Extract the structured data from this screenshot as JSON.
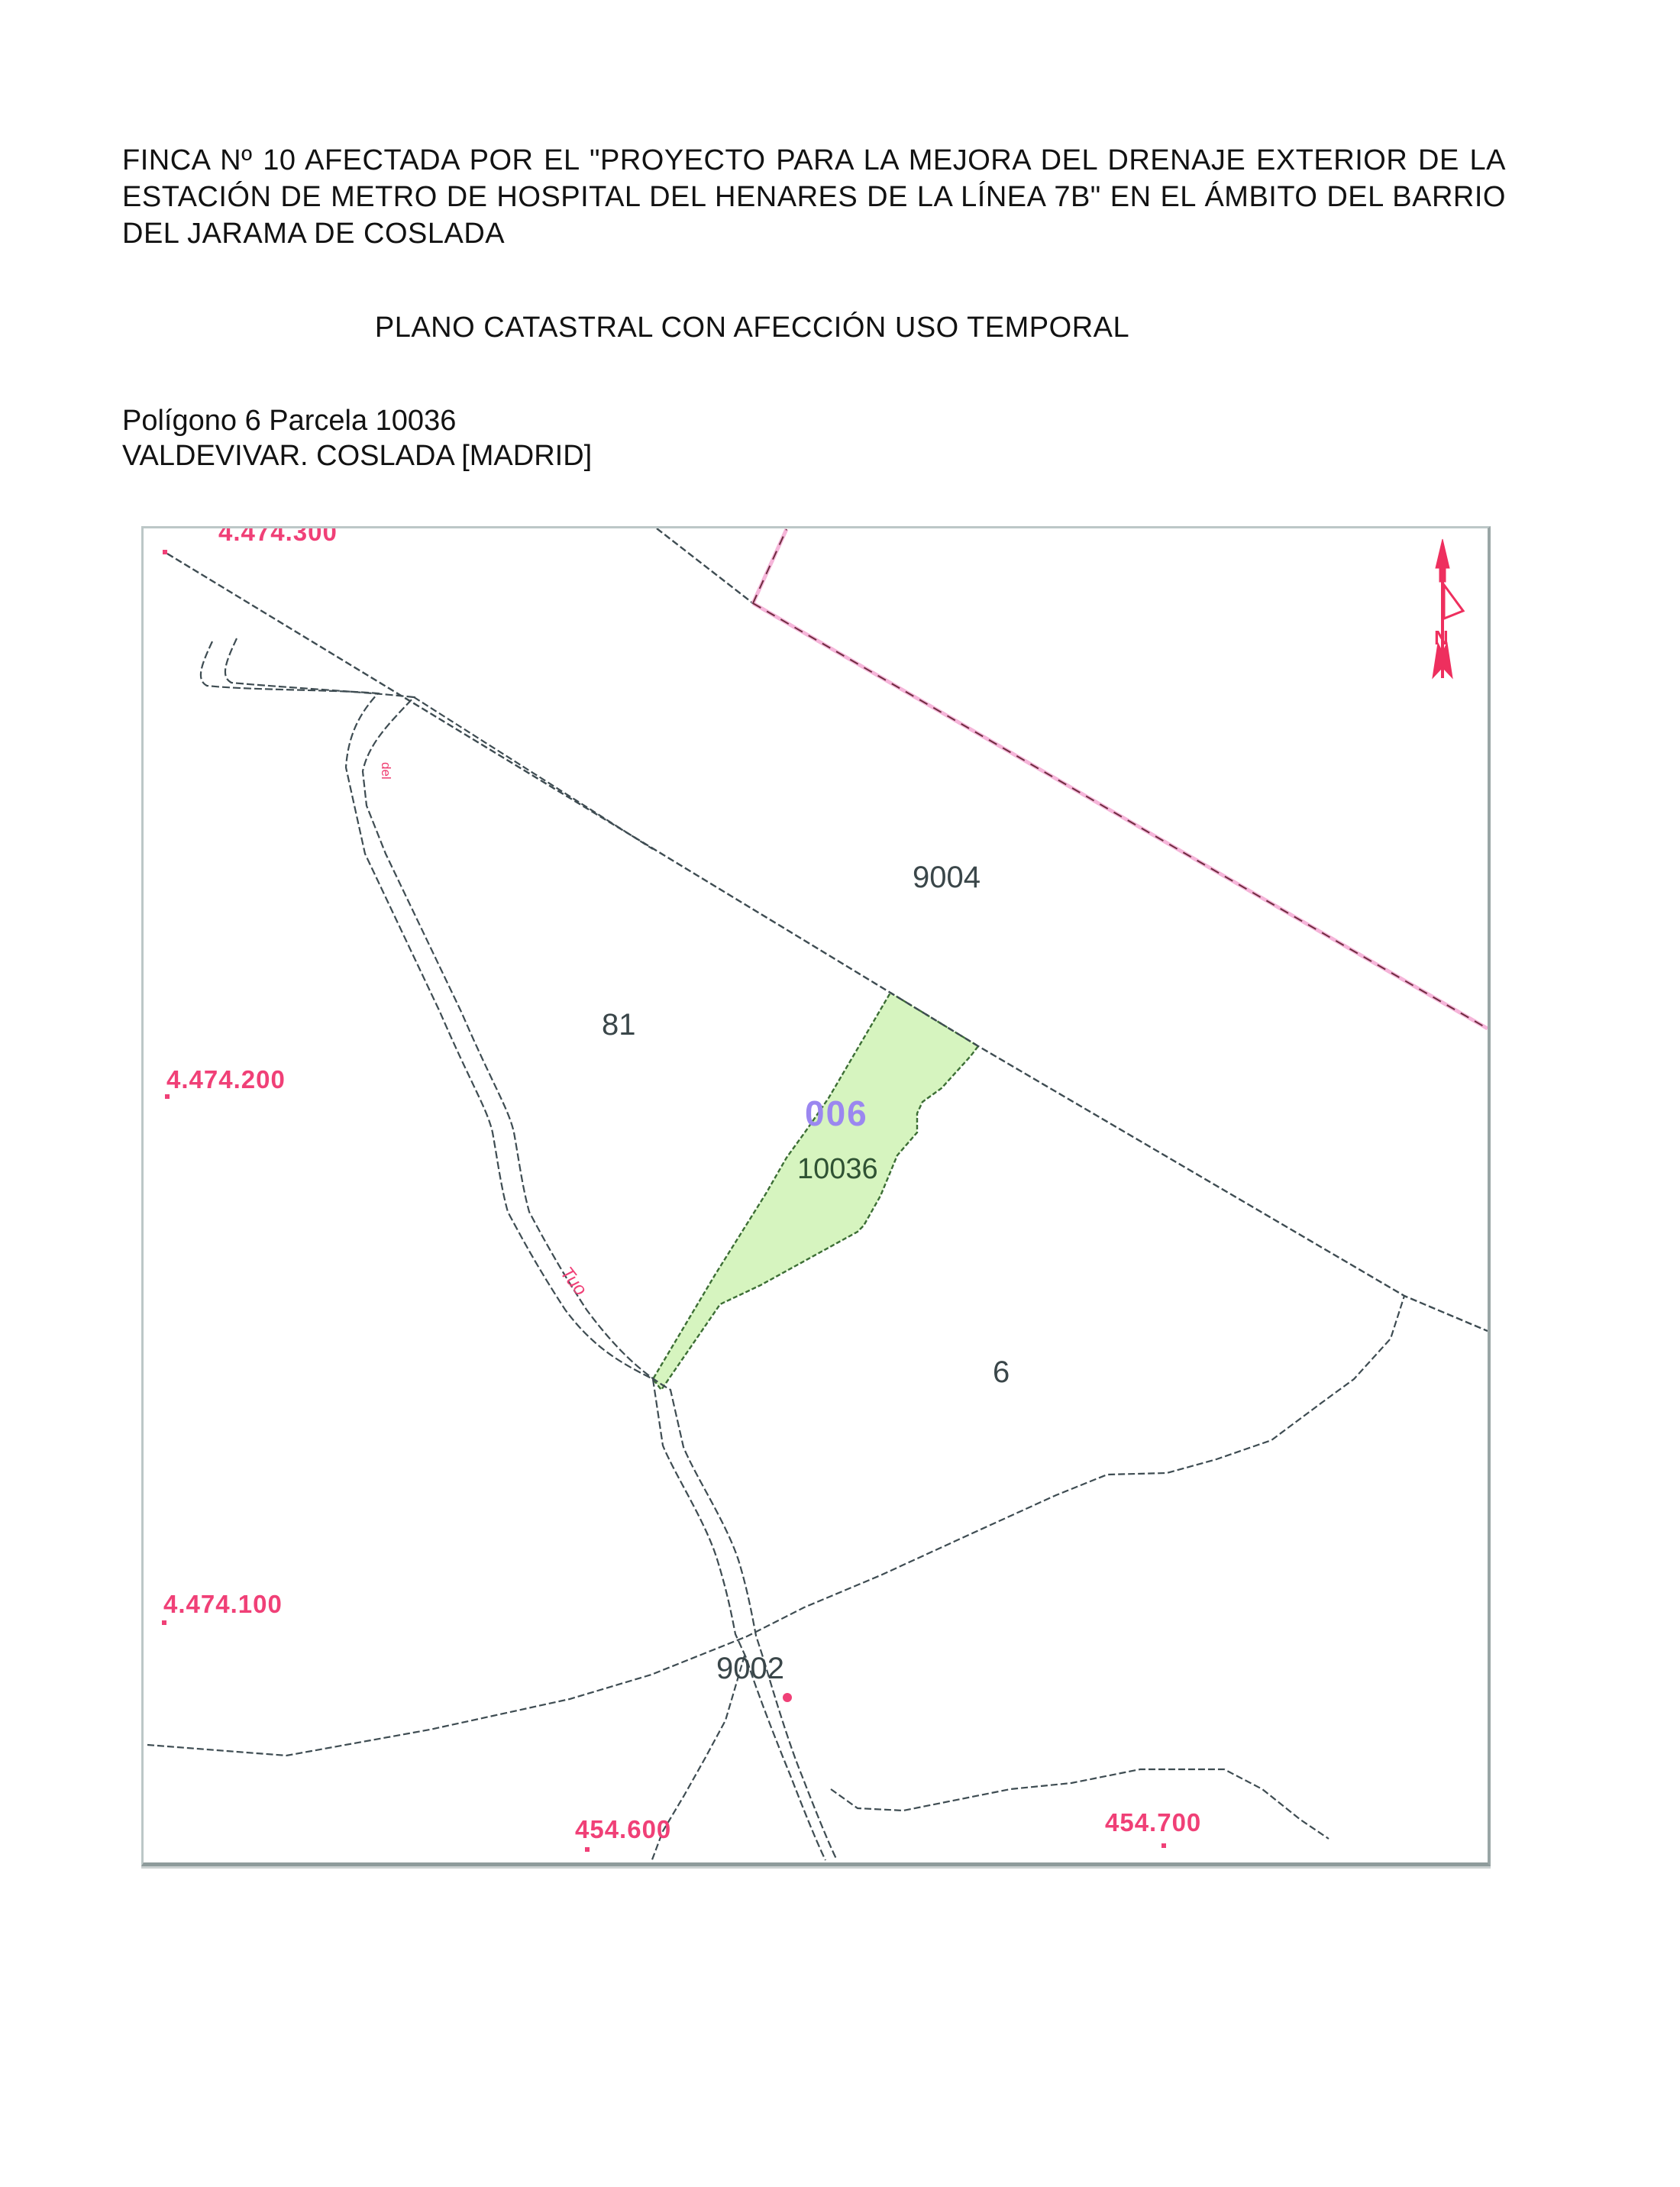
{
  "doc": {
    "title_lines": [
      "FINCA Nº 10 AFECTADA POR EL \"PROYECTO PARA LA MEJORA DEL DRENAJE EXTERIOR DE LA",
      "ESTACIÓN DE METRO DE HOSPITAL DEL HENARES DE LA LÍNEA 7B\" EN EL ÁMBITO DEL BARRIO",
      "DEL JARAMA DE COSLADA"
    ],
    "subtitle": "PLANO CATASTRAL CON AFECCIÓN USO TEMPORAL",
    "location_lines": [
      "Polígono 6 Parcela 10036",
      "VALDEVIVAR. COSLADA [MADRID]"
    ]
  },
  "map": {
    "grid_labels": {
      "top_clipped": "4.474.300",
      "left_upper": "4.474.200",
      "left_lower": "4.474.100",
      "bottom_left": "454.600",
      "bottom_right": "454.700"
    },
    "parcel_labels": {
      "p9004": "9004",
      "p81": "81",
      "p6": "6",
      "p9002": "9002"
    },
    "affected_parcel": {
      "code": "006",
      "number": "10036"
    },
    "road_labels": {
      "vertical": "del",
      "diagonal": "Tuo"
    },
    "colors": {
      "grid_label_pink": "#f04077",
      "boundary_line": "#3e4c52",
      "municipal_boundary_pink": "#f5b5d9",
      "affected_fill_green": "#d6f4bf",
      "affected_stroke_green": "#3c6e35",
      "affected_code_purple": "#9b87f0",
      "north_arrow_red": "#ee2f5e"
    }
  }
}
